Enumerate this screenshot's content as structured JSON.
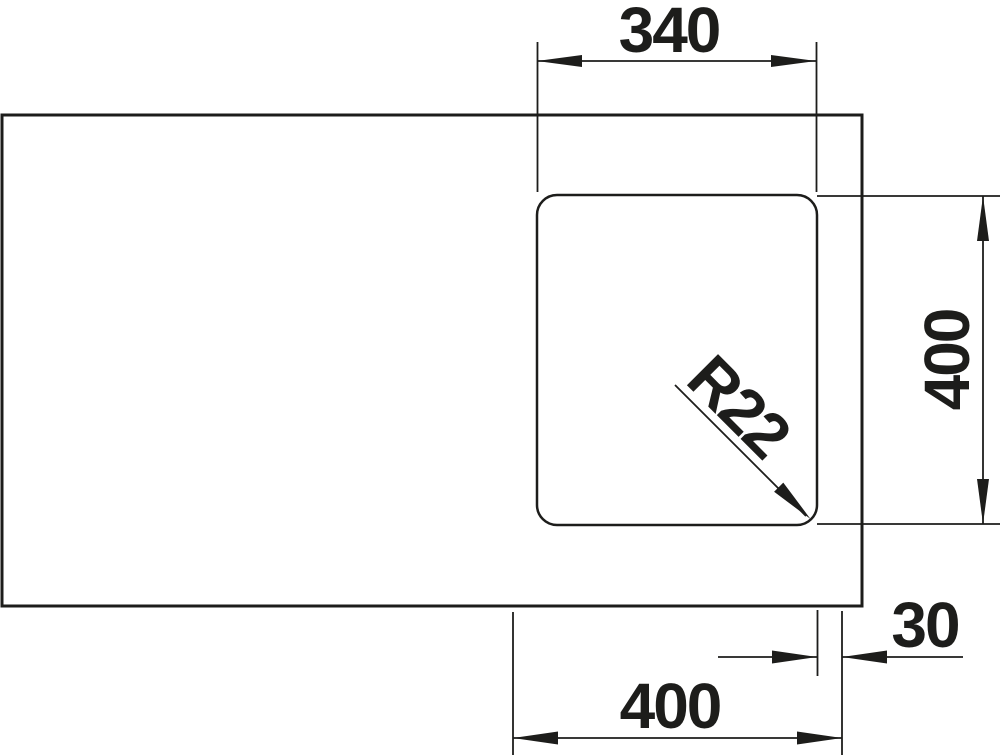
{
  "drawing": {
    "type": "sink-technical-drawing",
    "colors": {
      "line": "#1d1d1b",
      "background": "#ffffff"
    },
    "dimensions": {
      "bowl_width": {
        "label": "340"
      },
      "bowl_depth": {
        "label": "400"
      },
      "corner_radius": {
        "label": "R22"
      },
      "edge_offset": {
        "label": "30"
      },
      "cutout_width": {
        "label": "400"
      }
    }
  }
}
